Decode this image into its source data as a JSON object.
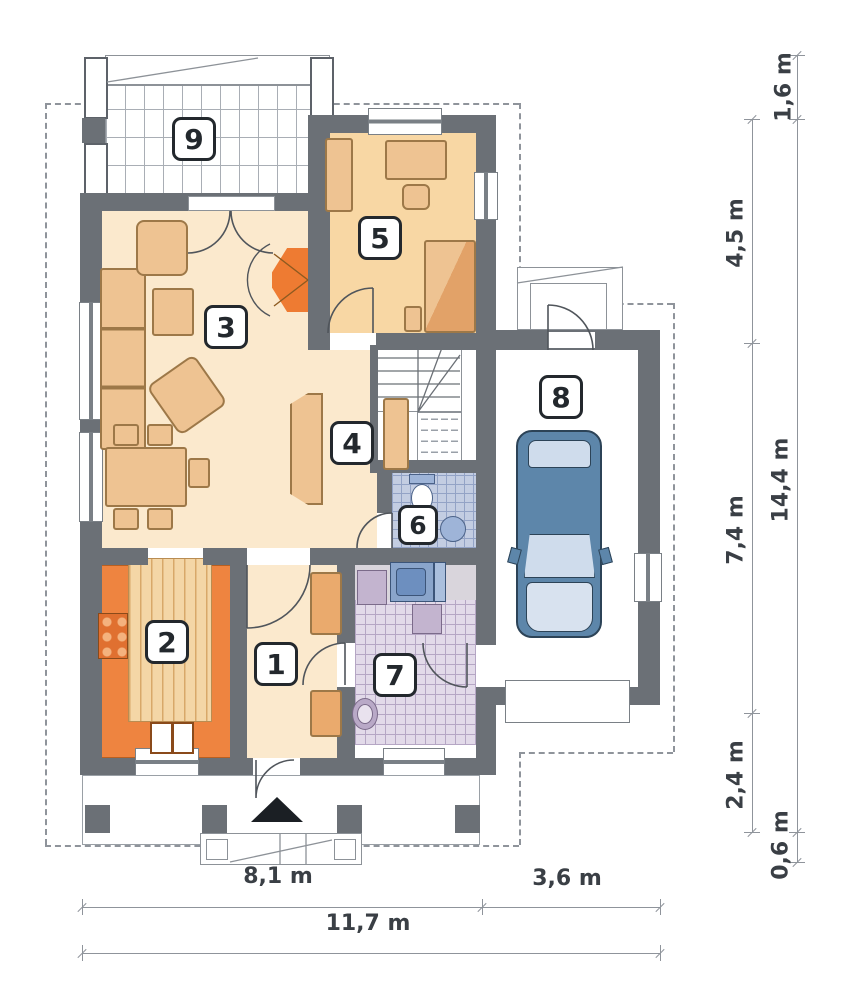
{
  "plan_title": "house-ground-floor-plan",
  "rooms": [
    {
      "number": "1"
    },
    {
      "number": "2"
    },
    {
      "number": "3"
    },
    {
      "number": "4"
    },
    {
      "number": "5"
    },
    {
      "number": "6"
    },
    {
      "number": "7"
    },
    {
      "number": "8"
    },
    {
      "number": "9"
    }
  ],
  "dimensions": {
    "right": [
      {
        "label": "1,6 m"
      },
      {
        "label": "4,5 m"
      },
      {
        "label": "14,4 m"
      },
      {
        "label": "7,4 m"
      },
      {
        "label": "2,4 m"
      },
      {
        "label": "0,6 m"
      }
    ],
    "bottom": [
      {
        "label": "8,1 m"
      },
      {
        "label": "3,6 m"
      },
      {
        "label": "11,7 m"
      }
    ]
  },
  "colors": {
    "wall": "#6b7076",
    "floor_main": "#fbe9cd",
    "floor_room5": "#f8d7a4",
    "accent_orange": "#ee8440",
    "furniture_tan": "#eec392",
    "tile_bath": "#e2dae9",
    "tile_wc": "#c3cde2",
    "car_blue": "#5d86aa",
    "dashed_line": "#8f949b",
    "dimension_text": "#3a3f45"
  }
}
